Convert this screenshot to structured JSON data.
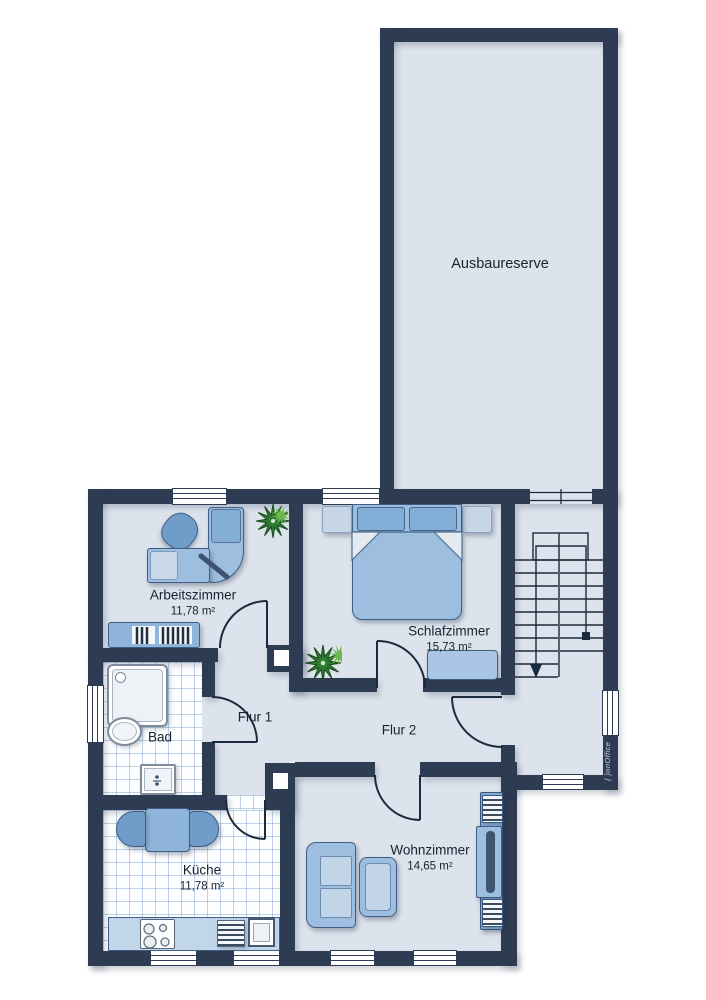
{
  "plan_type": "floor-plan",
  "rooms": {
    "ausbaureserve": {
      "name": "Ausbaureserve"
    },
    "arbeitszimmer": {
      "name": "Arbeitszimmer",
      "area": "11,78 m²"
    },
    "schlafzimmer": {
      "name": "Schlafzimmer",
      "area": "15,73 m²"
    },
    "bad": {
      "name": "Bad"
    },
    "flur1": {
      "name": "Flur 1"
    },
    "flur2": {
      "name": "Flur 2"
    },
    "kueche": {
      "name": "Küche",
      "area": "11,78 m²"
    },
    "wohnzimmer": {
      "name": "Wohnzimmer",
      "area": "14,65 m²"
    }
  },
  "watermark": {
    "symbol": "{ }",
    "brand": "onOffice"
  },
  "colors": {
    "wall": "#2d3c52",
    "floor": "#dde3ec",
    "tile_line": "#8cacd2",
    "furniture_blue": "#9dbede",
    "furniture_dark_blue": "#6f9cc9",
    "furniture_light": "#c6d6e6",
    "plant_green": "#2e7d33",
    "outline": "#1b2a3d"
  }
}
